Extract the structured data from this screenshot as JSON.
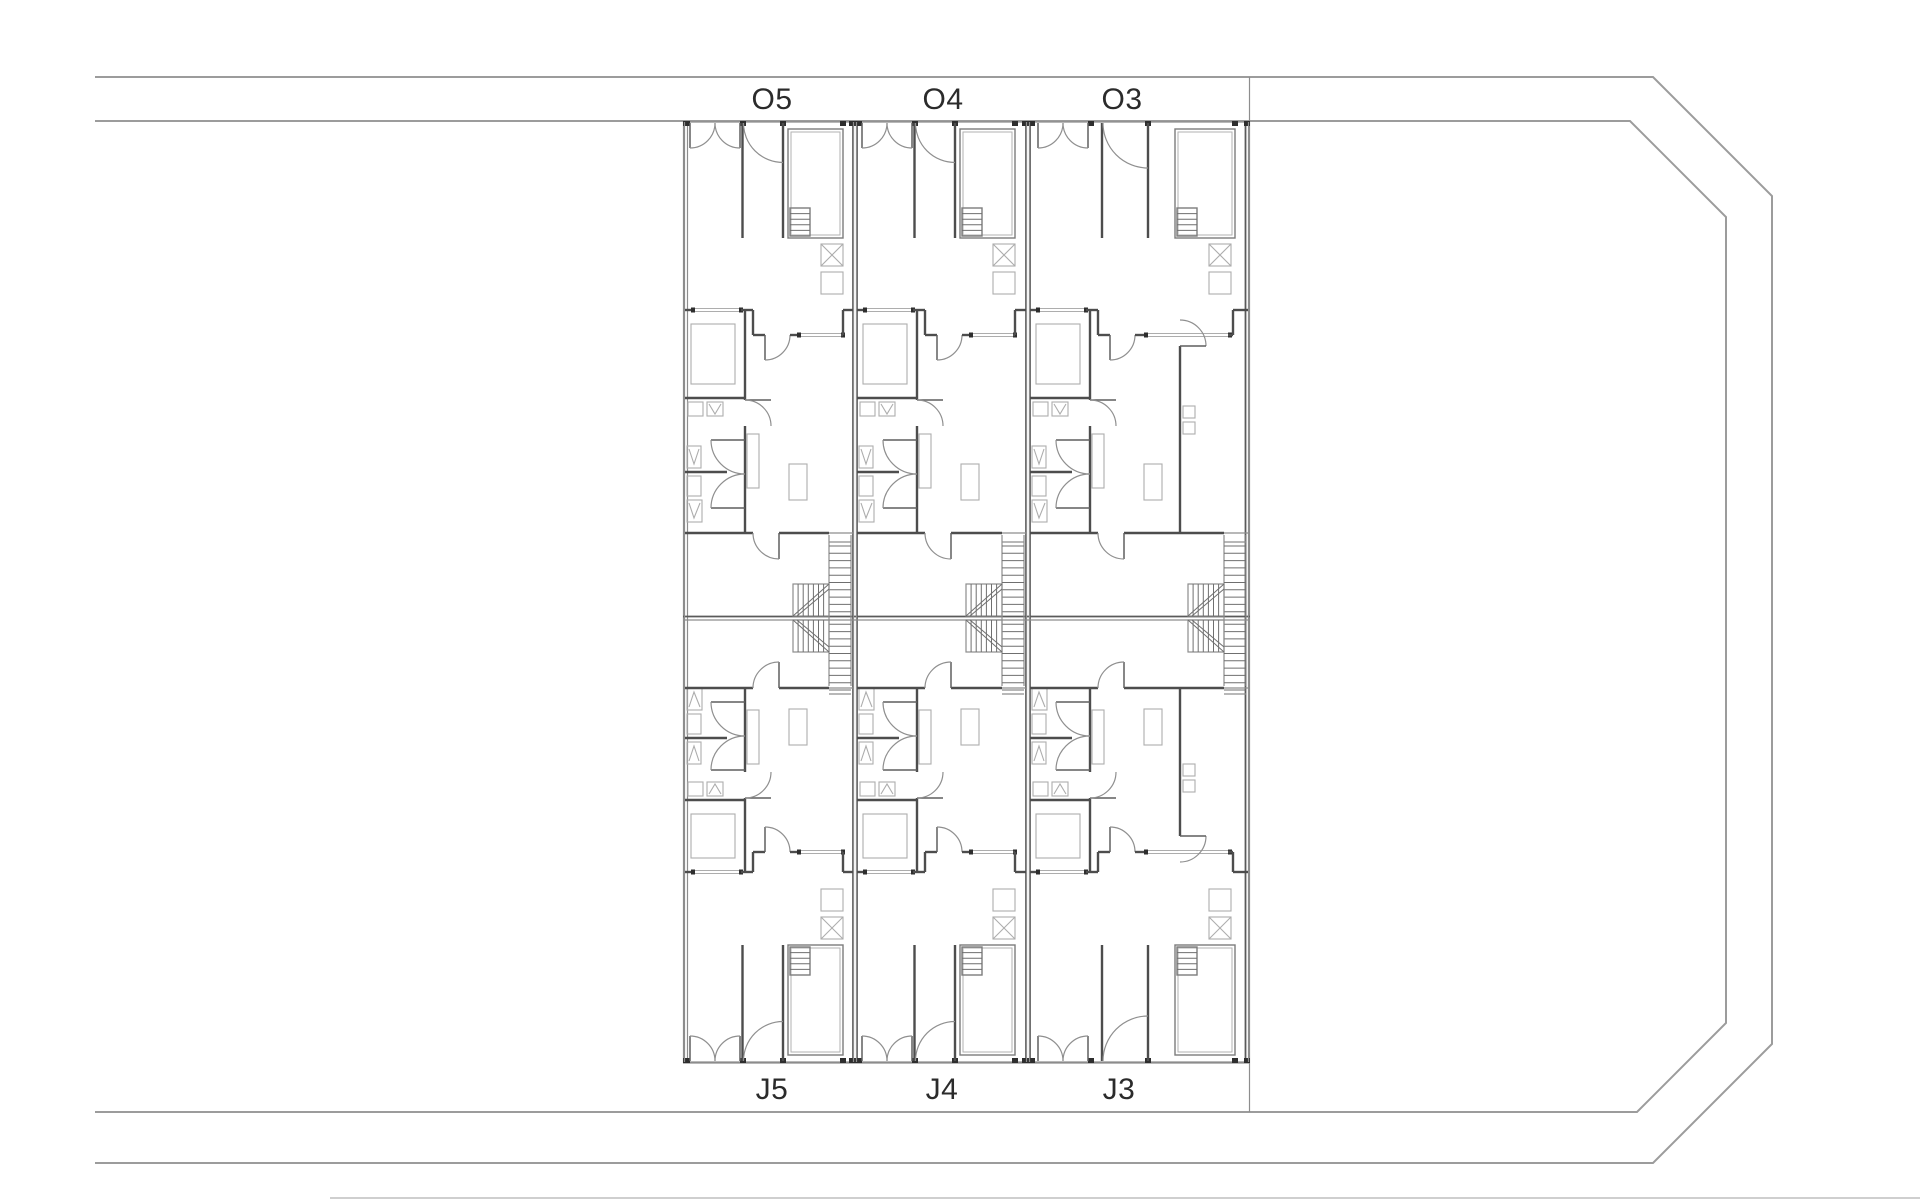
{
  "canvas": {
    "width": 1920,
    "height": 1200,
    "background": "#ffffff"
  },
  "drawing_type": "architectural-site-floor-plan",
  "colors": {
    "background": "#ffffff",
    "site_line": "#9c9c9c",
    "thin_line": "#8d8d8d",
    "wall": "#4d4d4d",
    "dark_jamb": "#2e2e2e",
    "fixture": "#adadad",
    "hatch": "#6f6f6f",
    "label_text": "#2b2b2b"
  },
  "site": {
    "outer_boundary": [
      [
        95,
        77
      ],
      [
        1653,
        77
      ],
      [
        1772,
        196
      ],
      [
        1772,
        1044
      ],
      [
        1653,
        1163
      ],
      [
        95,
        1163
      ]
    ],
    "inner_boundary": [
      [
        95,
        121
      ],
      [
        1630,
        121
      ],
      [
        1726,
        217
      ],
      [
        1726,
        1023
      ],
      [
        1637,
        1112
      ],
      [
        95,
        1112
      ]
    ],
    "bottom_tick_line": {
      "x1": 330,
      "y1": 1198,
      "x2": 1920,
      "y2": 1198
    }
  },
  "block": {
    "left": 683,
    "right": 1250,
    "street_top_y": 121,
    "party_y": 618,
    "street_bottom_y": 1063,
    "party_wall_x": [
      855,
      1028
    ],
    "rows": {
      "top": {
        "garden_depth": 189,
        "house_depth": 308
      },
      "bottom": {
        "garden_depth": 191,
        "house_depth": 254
      }
    }
  },
  "units": {
    "top_label_baseline_y": 109,
    "bottom_label_baseline_y": 1099,
    "list": [
      {
        "id": "O5",
        "label": "O5",
        "row": "top",
        "x": 683,
        "width": 172,
        "label_cx": 772,
        "variant": "standard"
      },
      {
        "id": "O4",
        "label": "O4",
        "row": "top",
        "x": 855,
        "width": 173,
        "label_cx": 943,
        "variant": "standard"
      },
      {
        "id": "O3",
        "label": "O3",
        "row": "top",
        "x": 1028,
        "width": 222,
        "label_cx": 1122,
        "variant": "wide"
      },
      {
        "id": "J5",
        "label": "J5",
        "row": "bottom",
        "x": 683,
        "width": 172,
        "label_cx": 772,
        "variant": "standard"
      },
      {
        "id": "J4",
        "label": "J4",
        "row": "bottom",
        "x": 855,
        "width": 173,
        "label_cx": 942,
        "variant": "standard"
      },
      {
        "id": "J3",
        "label": "J3",
        "row": "bottom",
        "x": 1028,
        "width": 222,
        "label_cx": 1119,
        "variant": "wide"
      }
    ]
  }
}
